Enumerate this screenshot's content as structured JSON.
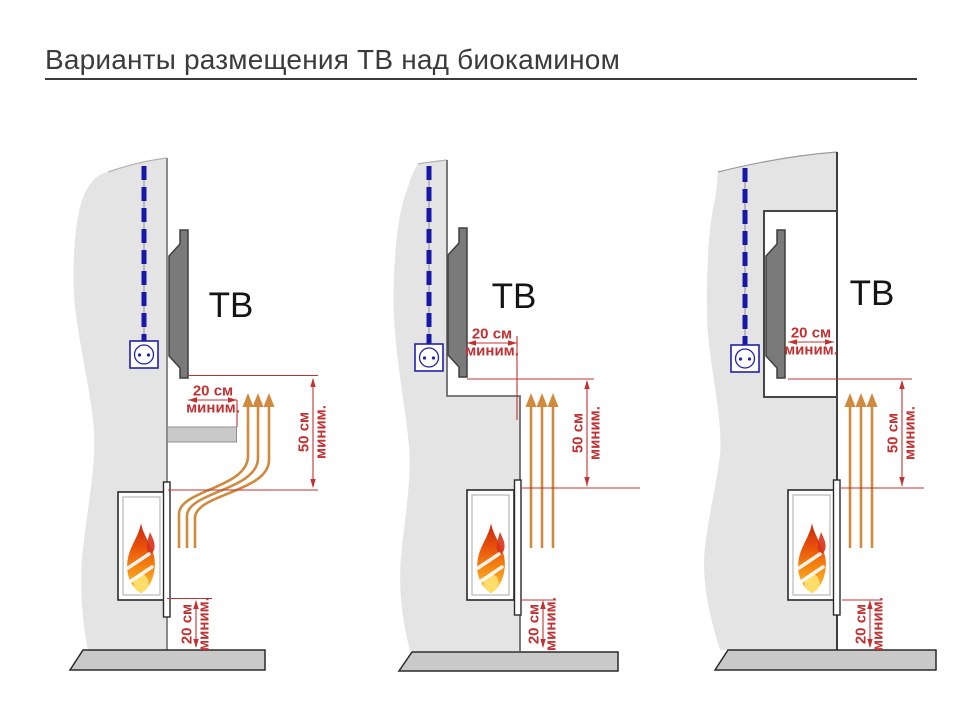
{
  "title": "Варианты размещения ТВ над биокамином",
  "colors": {
    "dimension_red": "#C13131",
    "heat_arrow_orange": "#D08A3E",
    "cable_blue": "#1818A8",
    "outlet_blue": "#2222AA",
    "wall_gray": "#E4E4E4",
    "floor_gray": "#C9C9C9",
    "tv_gray": "#7A7A7A",
    "flame_red": "#D8321A",
    "flame_orange": "#F07010",
    "flame_yellow": "#FFC83C",
    "title_gray": "#3B3B3B"
  },
  "diagrams": [
    {
      "tv_label": "ТВ",
      "dims": {
        "tv_clearance": {
          "value": "20 см",
          "qualifier": "миним."
        },
        "vertical_gap": {
          "value": "50 см",
          "qualifier": "миним."
        },
        "floor_gap": {
          "value": "20 см",
          "qualifier": "миним."
        }
      }
    },
    {
      "tv_label": "ТВ",
      "dims": {
        "tv_clearance": {
          "value": "20 см",
          "qualifier": "миним."
        },
        "vertical_gap": {
          "value": "50 см",
          "qualifier": "миним."
        },
        "floor_gap": {
          "value": "20 см",
          "qualifier": "миним."
        }
      }
    },
    {
      "tv_label": "ТВ",
      "dims": {
        "tv_clearance": {
          "value": "20 см",
          "qualifier": "миним."
        },
        "vertical_gap": {
          "value": "50 см",
          "qualifier": "миним."
        },
        "floor_gap": {
          "value": "20 см",
          "qualifier": "миним."
        }
      }
    }
  ]
}
